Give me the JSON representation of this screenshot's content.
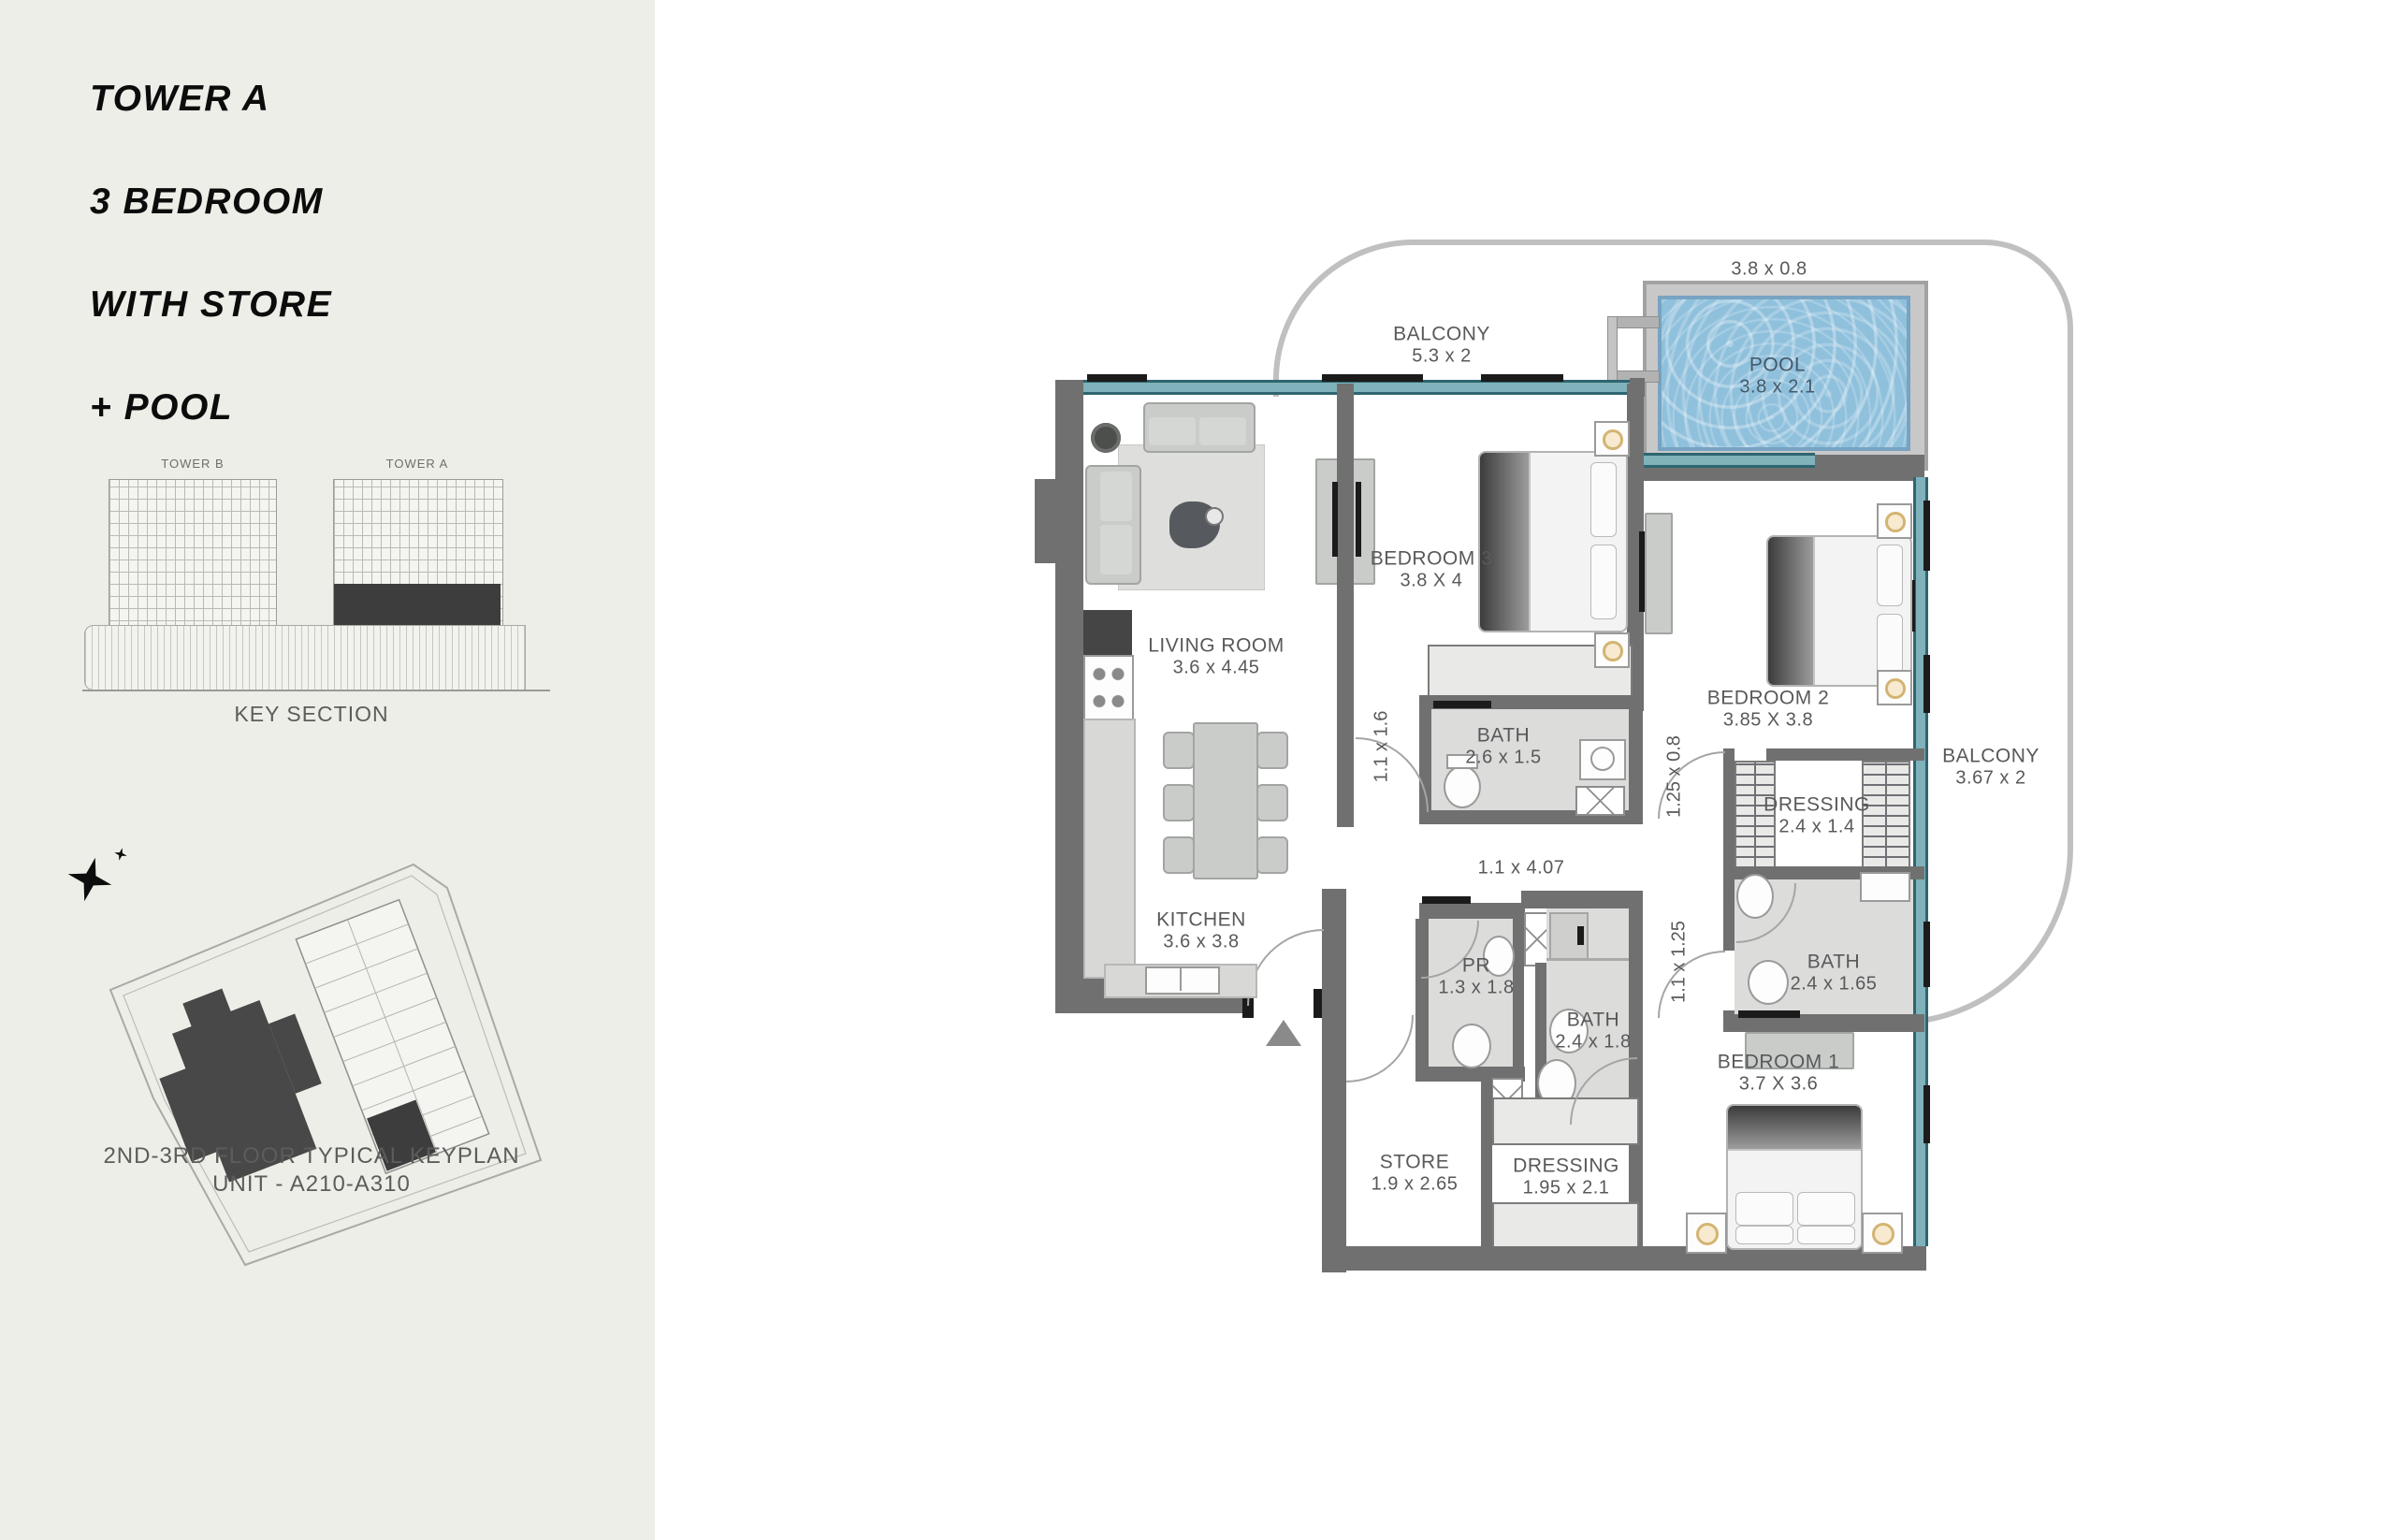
{
  "sidebar": {
    "title_lines": [
      "TOWER A",
      "3 BEDROOM",
      "WITH STORE",
      "+ POOL"
    ],
    "key_section": {
      "tower_b_label": "TOWER B",
      "tower_a_label": "TOWER A",
      "caption": "KEY SECTION"
    },
    "keyplan": {
      "caption_line1": "2ND-3RD FLOOR TYPICAL KEYPLAN",
      "caption_line2": "UNIT - A210-A310"
    }
  },
  "plan": {
    "rooms": {
      "balcony_top": {
        "name": "BALCONY",
        "dims": "5.3 x 2"
      },
      "pool": {
        "name": "POOL",
        "dims": "3.8 x 2.1"
      },
      "pool_deck_dims": "3.8 x 0.8",
      "living": {
        "name": "LIVING ROOM",
        "dims": "3.6 x  4.45"
      },
      "bedroom3": {
        "name": "BEDROOM 3",
        "dims": "3.8 X 4"
      },
      "bedroom2": {
        "name": "BEDROOM 2",
        "dims": "3.85 X 3.8"
      },
      "bath_26": {
        "name": "BATH",
        "dims": "2.6 x 1.5"
      },
      "kitchen": {
        "name": "KITCHEN",
        "dims": "3.6 x  3.8"
      },
      "dressing_24": {
        "name": "DRESSING",
        "dims": "2.4 x 1.4"
      },
      "balcony_right": {
        "name": "BALCONY",
        "dims": "3.67 x 2"
      },
      "bath_165": {
        "name": "BATH",
        "dims": "2.4 x 1.65"
      },
      "pr": {
        "name": "PR",
        "dims": "1.3 x 1.8"
      },
      "bath_18": {
        "name": "BATH",
        "dims": "2.4 x 1.8"
      },
      "bedroom1": {
        "name": "BEDROOM 1",
        "dims": "3.7 X 3.6"
      },
      "store": {
        "name": "STORE",
        "dims": "1.9 x 2.65"
      },
      "dressing_195": {
        "name": "DRESSING",
        "dims": "1.95 x 2.1"
      }
    },
    "passages": {
      "p1": "1.1 x 1.6",
      "p2": "1.25 x 0.8",
      "p3": "1.1 x  4.07",
      "p4": "1.1 x 1.25"
    },
    "colors": {
      "sidebar_bg": "#eeeee8",
      "wall": "#707070",
      "glass_teal": "#7fb2ba",
      "glass_edge": "#2e6570",
      "pool_water": "#8fc0dc",
      "parapet": "#c0c0c0",
      "label_text": "#58595b",
      "keyplan_dark": "#3d3d3d"
    }
  }
}
